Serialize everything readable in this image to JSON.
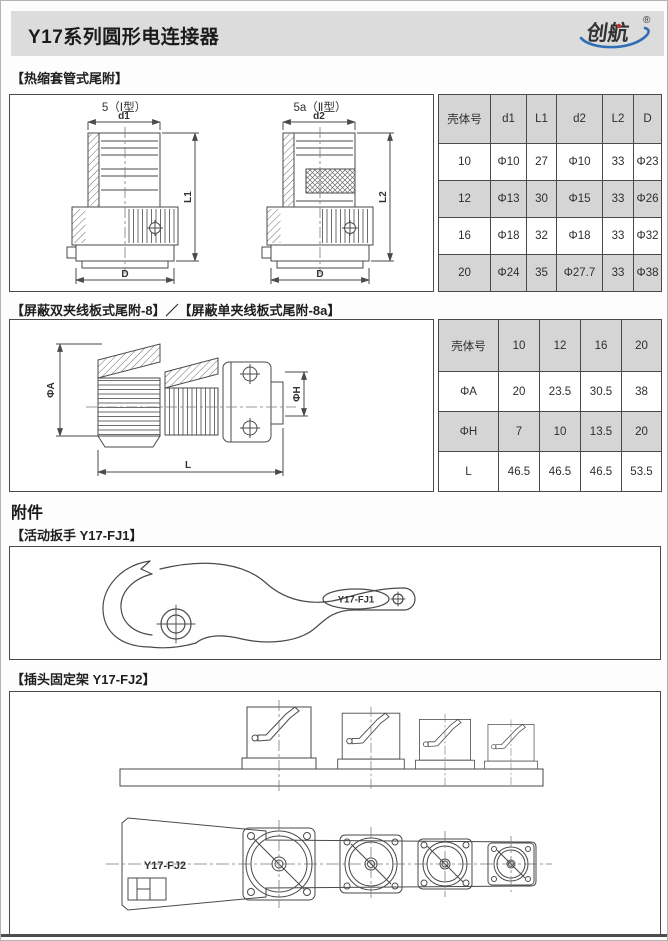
{
  "colors": {
    "header_bg": "#dcdcdc",
    "table_shade": "#d5d5d5",
    "drawing_line": "#4a4a4a",
    "logo_blue": "#2f6db5",
    "logo_red": "#c03030"
  },
  "header": {
    "title": "Y17系列圆形电连接器",
    "logo": {
      "text": "创航",
      "reg": "®"
    }
  },
  "section1": {
    "heading": "【热缩套管式尾附】",
    "drawing": {
      "type1_label": "5（Ⅰ型）",
      "type2_label": "5a（Ⅱ型）",
      "dim_d1": "d1",
      "dim_l1": "L1",
      "dim_d2": "d2",
      "dim_l2": "L2",
      "dim_d": "D"
    },
    "table": {
      "headers": [
        "壳体号",
        "d1",
        "L1",
        "d2",
        "L2",
        "D"
      ],
      "rows": [
        [
          "10",
          "Φ10",
          "27",
          "Φ10",
          "33",
          "Φ23"
        ],
        [
          "12",
          "Φ13",
          "30",
          "Φ15",
          "33",
          "Φ26"
        ],
        [
          "16",
          "Φ18",
          "32",
          "Φ18",
          "33",
          "Φ32"
        ],
        [
          "20",
          "Φ24",
          "35",
          "Φ27.7",
          "33",
          "Φ38"
        ]
      ]
    }
  },
  "section2": {
    "heading": "【屏蔽双夹线板式尾附-8】／【屏蔽单夹线板式尾附-8a】",
    "drawing": {
      "dim_a": "ΦA",
      "dim_h": "ΦH",
      "dim_l": "L"
    },
    "table": {
      "rows": [
        [
          "壳体号",
          "10",
          "12",
          "16",
          "20"
        ],
        [
          "ΦA",
          "20",
          "23.5",
          "30.5",
          "38"
        ],
        [
          "ΦH",
          "7",
          "10",
          "13.5",
          "20"
        ],
        [
          "L",
          "46.5",
          "46.5",
          "46.5",
          "53.5"
        ]
      ]
    }
  },
  "accessories": {
    "heading": "附件",
    "wrench": {
      "heading": "【活动扳手 Y17-FJ1】",
      "part_label": "Y17-FJ1"
    },
    "fixture": {
      "heading": "【插头固定架 Y17-FJ2】",
      "part_label": "Y17-FJ2"
    }
  }
}
